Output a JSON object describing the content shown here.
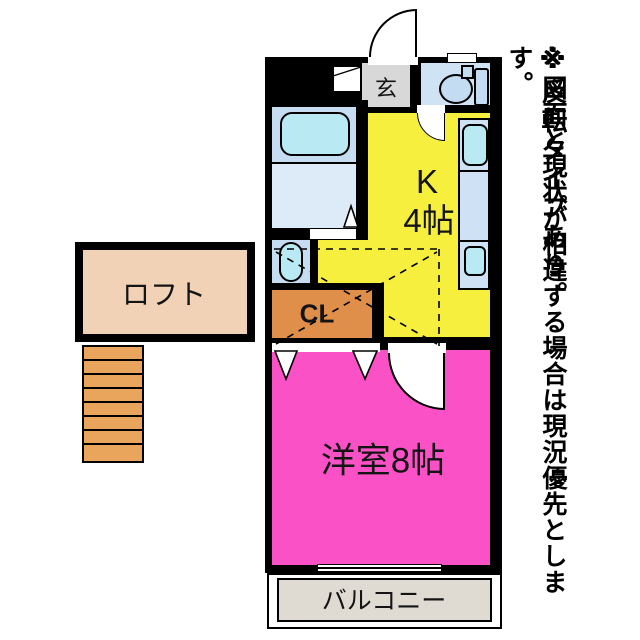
{
  "plan": {
    "rooms": {
      "entrance_label": "玄",
      "kitchen_label_line1": "K",
      "kitchen_label_line2": "4帖",
      "main_room_label": "洋室8帖",
      "closet_label": "CL",
      "loft_label": "ロフト",
      "balcony_label": "バルコニー"
    },
    "colors": {
      "wall": "#000000",
      "kitchen": "#f6ef3d",
      "main_room": "#fa52c6",
      "closet": "#df8f4a",
      "loft": "#f2d2b6",
      "stairs": "#eaa55c",
      "balcony": "#dfdbd3",
      "entrance": "#d8d8d8",
      "water_rooms": "#c6dcf0",
      "fixtures": "#b9eaf4"
    }
  },
  "notes": {
    "note1": "※反転タイプあり。",
    "note2": "※図面と現状が相違する場合は現況優先とします。"
  }
}
